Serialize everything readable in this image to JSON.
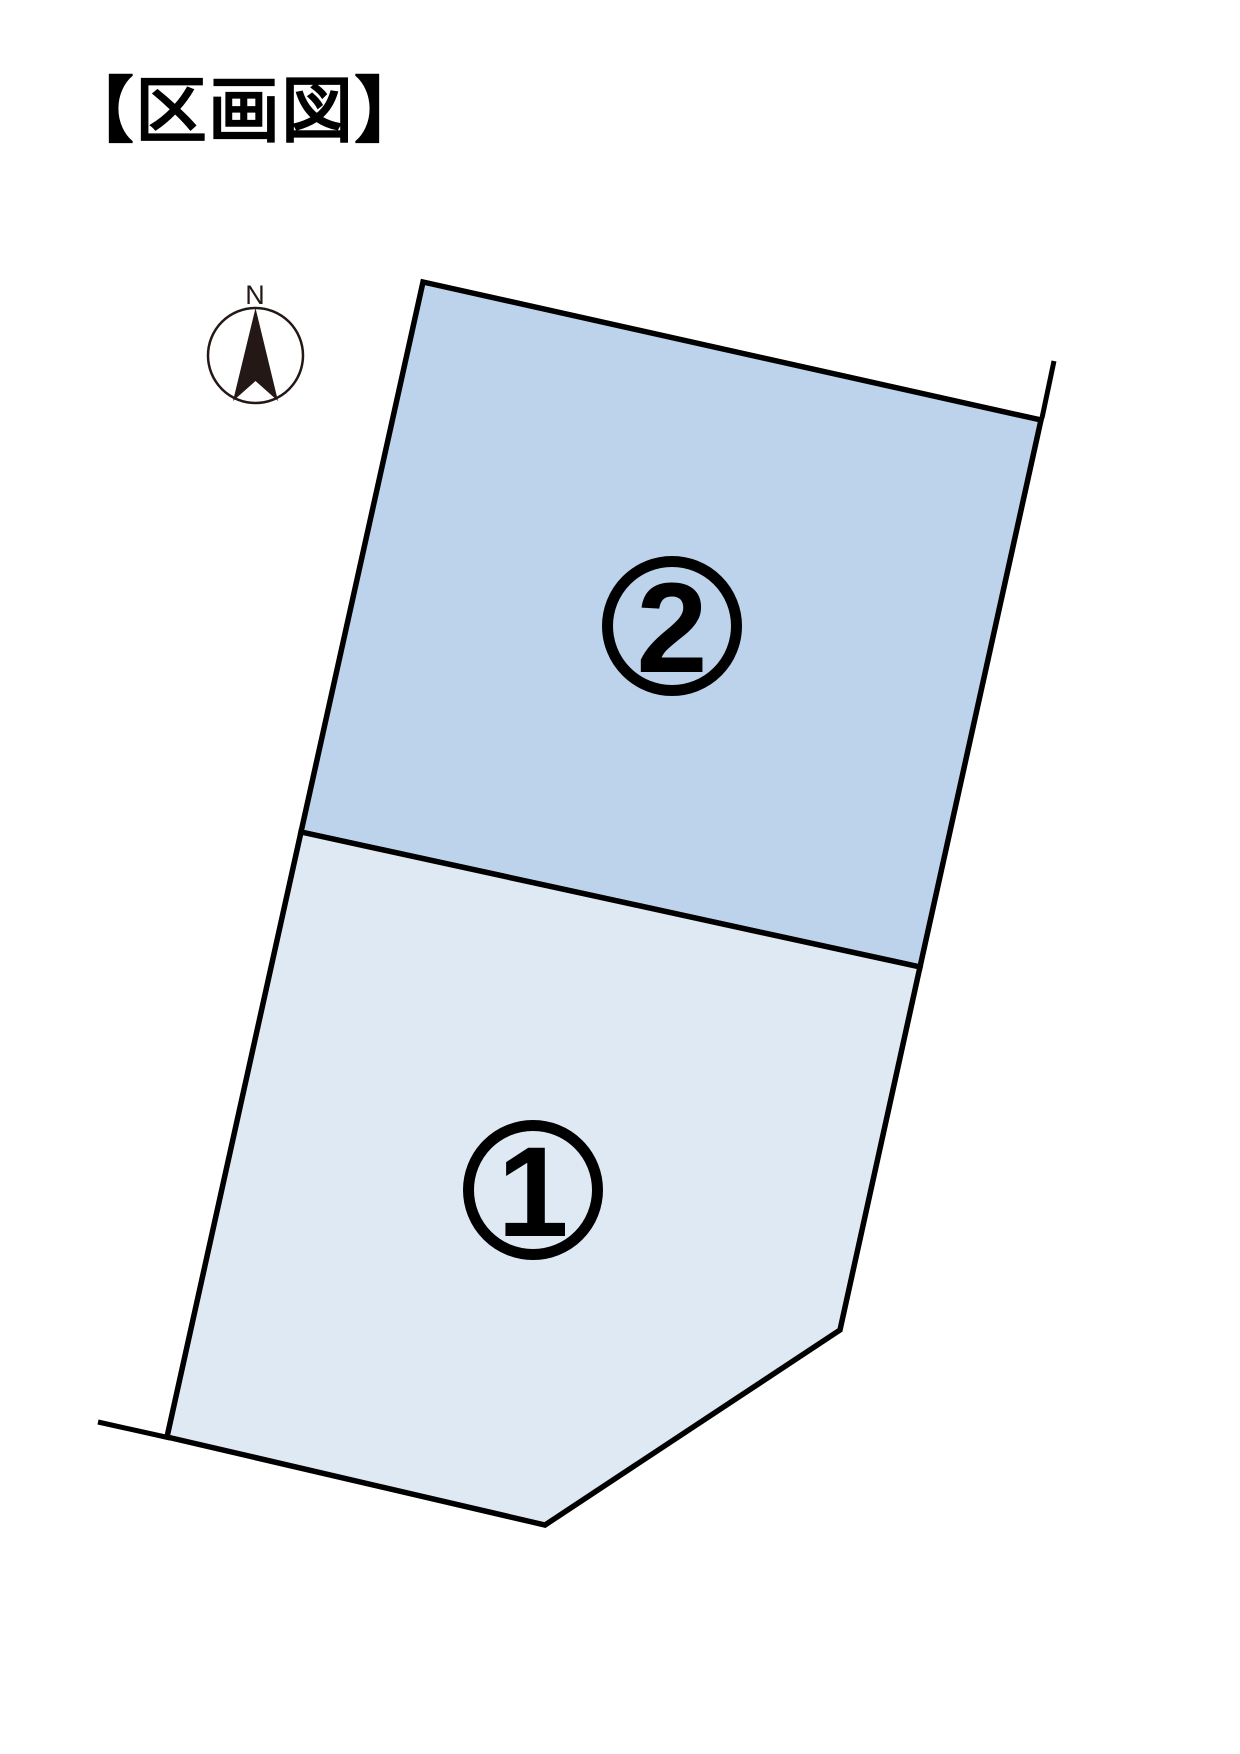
{
  "page": {
    "title": "【区画図】"
  },
  "compass": {
    "north_label": "N",
    "arrow_color": "#231815"
  },
  "diagram": {
    "outline_color": "#000000",
    "plots": [
      {
        "number": "1",
        "label": "①",
        "fill_color": "#dfe9f4"
      },
      {
        "number": "2",
        "label": "②",
        "fill_color": "#bdd2eb"
      }
    ]
  },
  "colors": {
    "background": "#ffffff",
    "line": "#000000"
  }
}
